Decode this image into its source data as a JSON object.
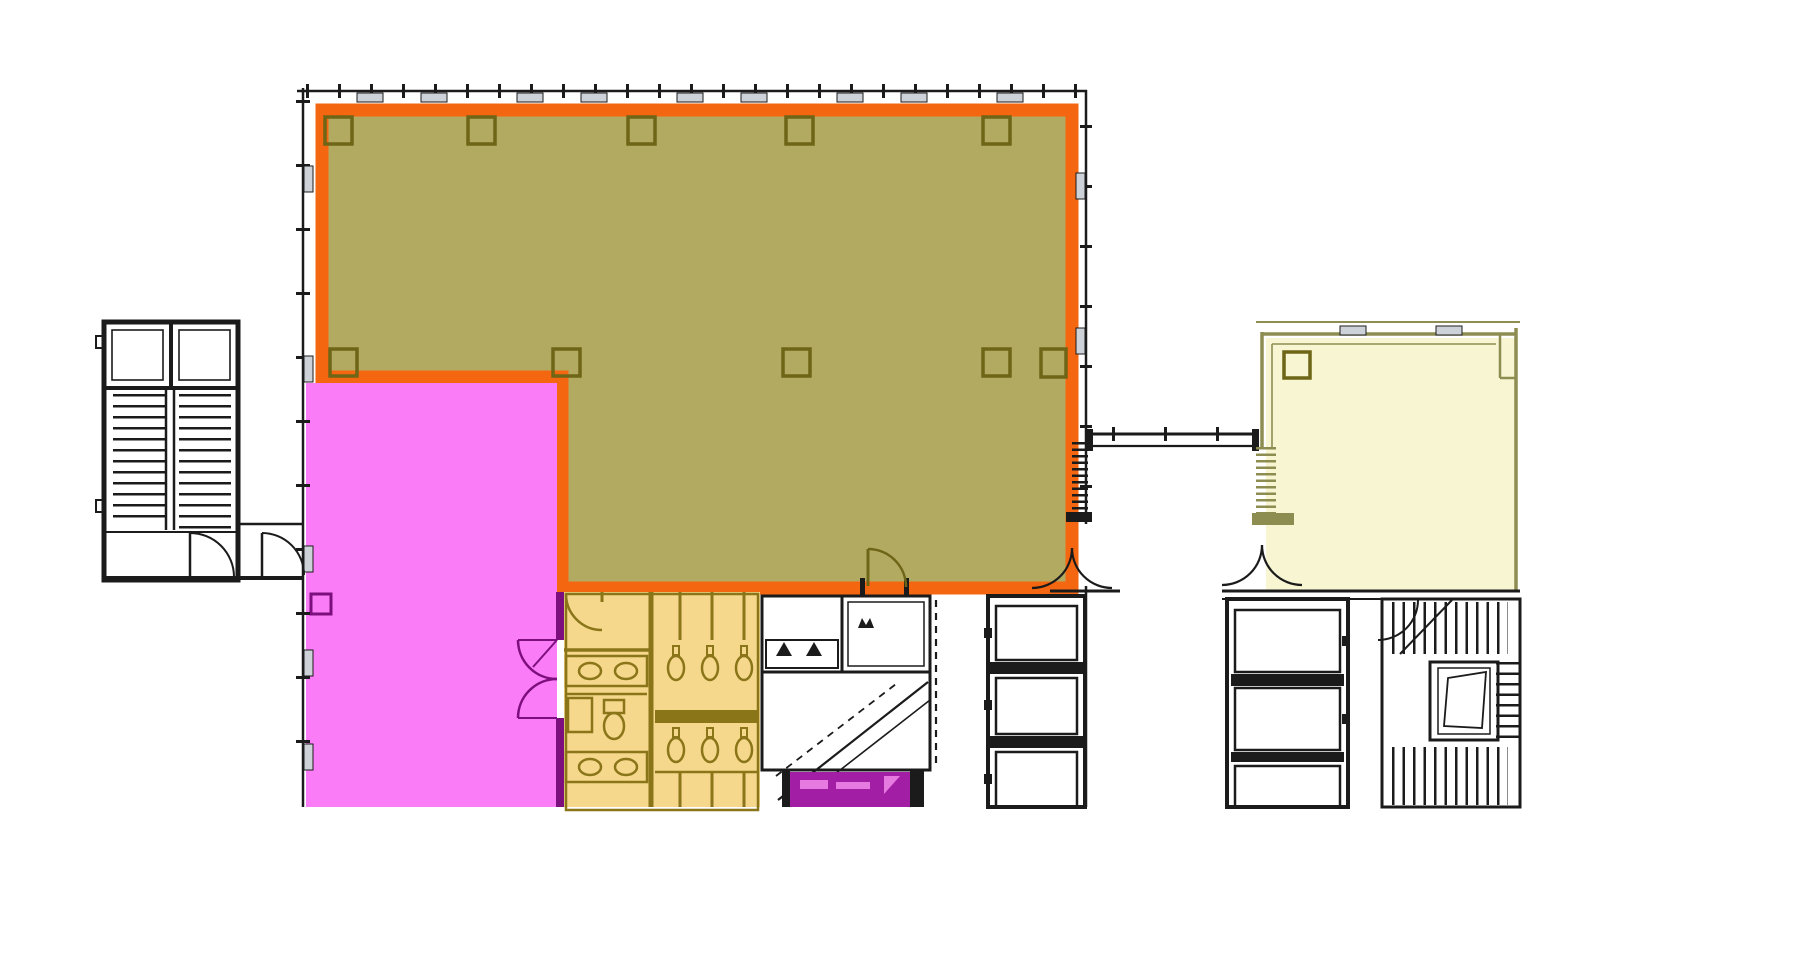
{
  "canvas": {
    "width": 1798,
    "height": 978
  },
  "colors": {
    "background": "#ffffff",
    "linework": "#1b1b1b",
    "highlight_outline": "#f4660f",
    "zone_olive_fill": "#b3aa62",
    "zone_olive_stroke": "#6e6516",
    "zone_pink_fill": "#fa7cf6",
    "zone_pink_stroke": "#7c0e7e",
    "zone_restroom_fill": "#f6d88d",
    "zone_restroom_stroke": "#8a7518",
    "zone_cream_fill": "#f8f5d2",
    "zone_cream_stroke": "#8d8d52",
    "zone_purple_fill": "#a21fa5",
    "zone_purple_accent": "#e77ae0",
    "window_sill_fill": "#ccd2d8"
  },
  "zones": [
    {
      "id": "olive-suite",
      "description": "Large L-shaped floor area highlighted olive with heavy orange outline",
      "fill_key": "zone_olive_fill",
      "outline_key": "highlight_outline"
    },
    {
      "id": "pink-room",
      "description": "Rectangular room highlighted bright pink, lower-left of main building",
      "fill_key": "zone_pink_fill",
      "outline_key": "zone_pink_stroke"
    },
    {
      "id": "restroom-core",
      "description": "Restroom block highlighted tan with brown fixtures",
      "fill_key": "zone_restroom_fill",
      "outline_key": "zone_restroom_stroke"
    },
    {
      "id": "purple-service-room",
      "description": "Small purple service room at bottom core, cut by image edge",
      "fill_key": "zone_purple_fill"
    },
    {
      "id": "east-wing",
      "description": "Cream highlighted area of the east building connected by bridge",
      "fill_key": "zone_cream_fill",
      "outline_key": "zone_cream_stroke"
    }
  ],
  "structures": [
    {
      "id": "west-stair-tower",
      "description": "Detached exterior stair tower at far left"
    },
    {
      "id": "bridge",
      "description": "Pedestrian link between main and east buildings"
    },
    {
      "id": "elevator-banks",
      "description": "Elevator shafts along the bottom service cores"
    },
    {
      "id": "east-stair",
      "description": "Stair with hatched treads in east building core"
    }
  ]
}
